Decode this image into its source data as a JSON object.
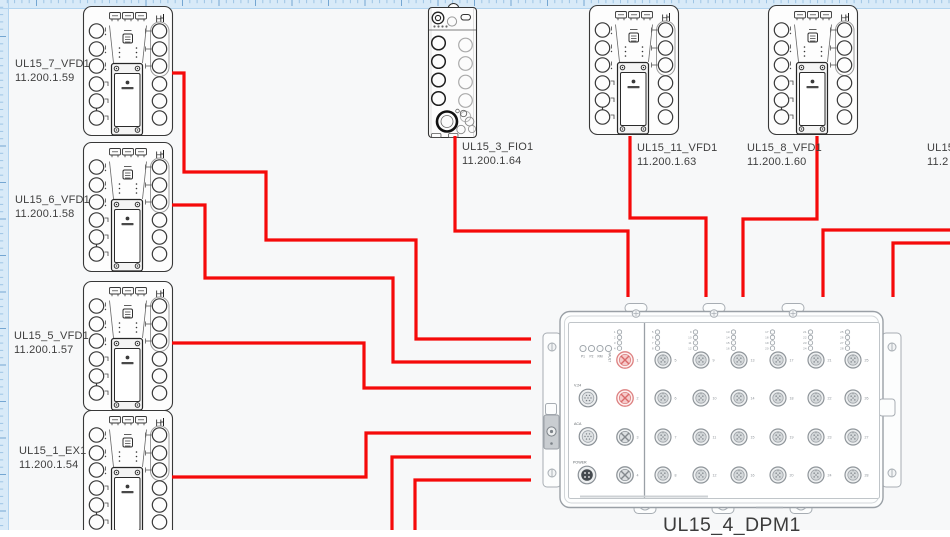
{
  "app": {
    "background": "#f7f8f9",
    "ruler": {
      "size": 8,
      "band": "#d8eaf8",
      "edge_line": "#b2d4ef",
      "minor_tick": "#9fc5e4",
      "major_tick": "#74a6d2",
      "minor_step": 7.3,
      "major_step": 36.5
    }
  },
  "colors": {
    "wire": "#f50a0a",
    "device_stroke": "#383838",
    "dpm_stroke": "#9aa0a6",
    "port_ring": "#8f959a",
    "port_fill": "#eef0f1",
    "port_inner": "#d5d9db",
    "highlight_ring": "#dd8080",
    "highlight_fill": "#f5caca"
  },
  "devices": [
    {
      "id": "vfd7",
      "name": "UL15_7_VFD1",
      "ip": "11.200.1.59",
      "kind": "vfd",
      "x": 83,
      "y": 6,
      "w": 90,
      "h": 130,
      "label": {
        "x": 15,
        "y": 58
      }
    },
    {
      "id": "vfd6",
      "name": "UL15_6_VFD1",
      "ip": "11.200.1.58",
      "kind": "vfd",
      "x": 83,
      "y": 142,
      "w": 90,
      "h": 130,
      "label": {
        "x": 15,
        "y": 194
      }
    },
    {
      "id": "vfd5",
      "name": "UL15_5_VFD1",
      "ip": "11.200.1.57",
      "kind": "vfd",
      "x": 83,
      "y": 281,
      "w": 90,
      "h": 130,
      "label": {
        "x": 14,
        "y": 330
      }
    },
    {
      "id": "ex1",
      "name": "UL15_1_EX1",
      "ip": "11.200.1.54",
      "kind": "vfd",
      "x": 83,
      "y": 410,
      "w": 90,
      "h": 130,
      "label": {
        "x": 19,
        "y": 445
      }
    },
    {
      "id": "fio3",
      "name": "UL15_3_FIO1",
      "ip": "11.200.1.64",
      "kind": "fio",
      "x": 428,
      "y": 7,
      "w": 49,
      "h": 131,
      "label": {
        "x": 462,
        "y": 141
      }
    },
    {
      "id": "vfd11",
      "name": "UL15_11_VFD1",
      "ip": "11.200.1.63",
      "kind": "vfd",
      "x": 589,
      "y": 5,
      "w": 90,
      "h": 131,
      "label": {
        "x": 637,
        "y": 142
      }
    },
    {
      "id": "vfd8",
      "name": "UL15_8_VFD1",
      "ip": "11.200.1.60",
      "kind": "vfd",
      "x": 768,
      "y": 5,
      "w": 90,
      "h": 131,
      "label": {
        "x": 747,
        "y": 142
      }
    },
    {
      "id": "edge",
      "name": "UL15",
      "ip": "11.2",
      "kind": "none",
      "label": {
        "x": 927,
        "y": 142
      }
    }
  ],
  "dpm": {
    "name": "UL15_4_DPM1",
    "label": {
      "x": 663,
      "y": 514
    },
    "status_leds": [
      "P1",
      "P2",
      "RM",
      "FAULT"
    ],
    "aux_ports": [
      "V.24",
      "ACA",
      "POWER"
    ],
    "port_count": 28,
    "highlighted_ports": [
      1,
      2
    ],
    "columns": [
      [
        1,
        2,
        3,
        4
      ],
      [
        5,
        6,
        7,
        8
      ],
      [
        9,
        10,
        11,
        12
      ],
      [
        13,
        14,
        15,
        16
      ],
      [
        17,
        18,
        19,
        20
      ],
      [
        21,
        22,
        23,
        24
      ],
      [
        25,
        26,
        27,
        28
      ]
    ],
    "col_x": [
      625,
      663,
      701,
      739,
      778,
      816,
      853
    ],
    "row_y": [
      360,
      398,
      437,
      475
    ]
  },
  "wires": [
    {
      "id": "w1",
      "from": "UL15_7_VFD1",
      "to": "UL15_4_DPM1",
      "points": [
        [
          172,
          73
        ],
        [
          184,
          73
        ],
        [
          184,
          172
        ],
        [
          266,
          172
        ],
        [
          266,
          240
        ],
        [
          416,
          240
        ],
        [
          416,
          339
        ],
        [
          531,
          339
        ]
      ]
    },
    {
      "id": "w2",
      "from": "UL15_6_VFD1",
      "to": "UL15_4_DPM1",
      "points": [
        [
          172,
          205
        ],
        [
          205,
          205
        ],
        [
          205,
          278
        ],
        [
          393,
          278
        ],
        [
          393,
          362
        ],
        [
          531,
          362
        ]
      ]
    },
    {
      "id": "w3",
      "from": "UL15_5_VFD1",
      "to": "UL15_4_DPM1",
      "points": [
        [
          172,
          343
        ],
        [
          364,
          343
        ],
        [
          364,
          388
        ],
        [
          531,
          388
        ]
      ]
    },
    {
      "id": "w4",
      "from": "UL15_1_EX1",
      "to": "UL15_4_DPM1",
      "points": [
        [
          172,
          477
        ],
        [
          366,
          477
        ],
        [
          366,
          433
        ],
        [
          531,
          433
        ]
      ]
    },
    {
      "id": "w5",
      "from": "UL15_3_FIO1",
      "to": "UL15_4_DPM1",
      "points": [
        [
          455,
          136
        ],
        [
          455,
          231
        ],
        [
          628,
          231
        ],
        [
          628,
          297
        ]
      ]
    },
    {
      "id": "w6",
      "from": "UL15_11_VFD1",
      "to": "UL15_4_DPM1",
      "points": [
        [
          630,
          136
        ],
        [
          630,
          218
        ],
        [
          706,
          218
        ],
        [
          706,
          297
        ]
      ]
    },
    {
      "id": "w7",
      "from": "UL15_8_VFD1",
      "to": "UL15_4_DPM1",
      "points": [
        [
          817,
          136
        ],
        [
          817,
          219
        ],
        [
          743,
          219
        ],
        [
          743,
          297
        ]
      ]
    },
    {
      "id": "w8",
      "from": "right-edge",
      "to": "UL15_4_DPM1",
      "points": [
        [
          952,
          230
        ],
        [
          823,
          230
        ],
        [
          823,
          297
        ]
      ]
    },
    {
      "id": "w9",
      "from": "right-edge",
      "to": "UL15_4_DPM1",
      "points": [
        [
          952,
          243
        ],
        [
          893,
          243
        ],
        [
          893,
          297
        ]
      ]
    },
    {
      "id": "w10",
      "from": "bottom-edge",
      "to": "UL15_4_DPM1",
      "points": [
        [
          392,
          532
        ],
        [
          392,
          457
        ],
        [
          531,
          457
        ]
      ]
    },
    {
      "id": "w11",
      "from": "bottom-edge",
      "to": "UL15_4_DPM1",
      "points": [
        [
          415,
          532
        ],
        [
          415,
          480
        ],
        [
          531,
          480
        ]
      ]
    }
  ]
}
